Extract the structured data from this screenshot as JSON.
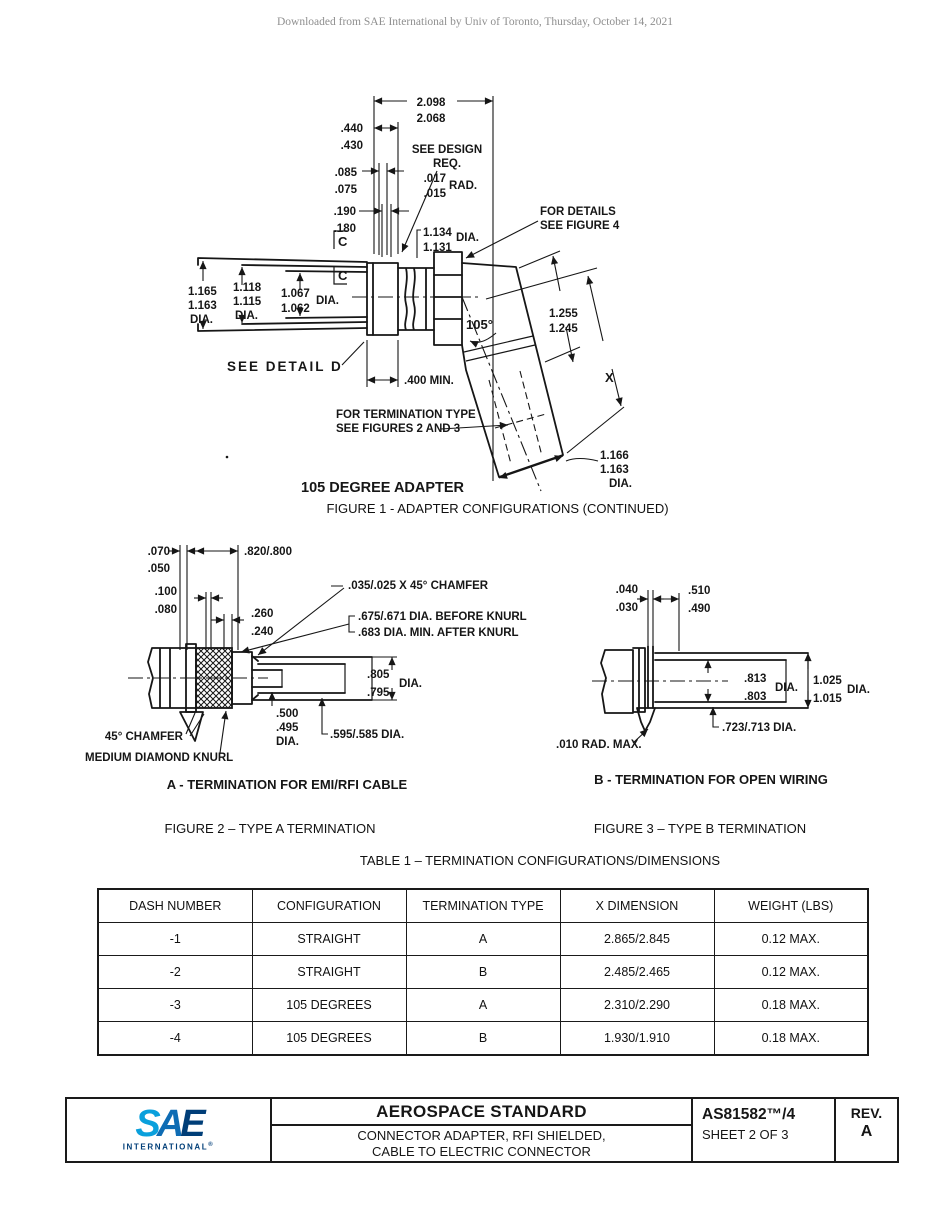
{
  "watermark": "Downloaded from SAE International by Univ of Toronto, Thursday, October 14, 2021",
  "figure1": {
    "title": "105 DEGREE ADAPTER",
    "caption": "FIGURE 1 - ADAPTER CONFIGURATIONS (CONTINUED)",
    "dims": {
      "overall": [
        "2.098",
        "2.068"
      ],
      "d440": [
        ".440",
        ".430"
      ],
      "design": [
        "SEE DESIGN",
        "REQ."
      ],
      "rad": [
        ".017",
        ".015",
        "RAD."
      ],
      "d085": [
        ".085",
        ".075"
      ],
      "d190": [
        ".190",
        ".180"
      ],
      "dia1134": [
        "1.134",
        "1.131",
        "DIA."
      ],
      "details": [
        "FOR DETAILS",
        "SEE FIGURE 4"
      ],
      "c": "C",
      "dia1165": [
        "1.165",
        "1.163",
        "DIA."
      ],
      "dia1118": [
        "1.118",
        "1.115",
        "DIA."
      ],
      "dia1067": [
        "1.067",
        "1.062",
        "DIA."
      ],
      "angle": "105°",
      "d1255": [
        "1.255",
        "1.245"
      ],
      "detail_d": "SEE DETAIL D",
      "min400": ".400 MIN.",
      "xdim": "X",
      "term": [
        "FOR TERMINATION TYPE",
        "SEE FIGURES 2 AND 3"
      ],
      "dia1166": [
        "1.166",
        "1.163",
        "DIA."
      ]
    }
  },
  "figure2": {
    "caption": "FIGURE 2 – TYPE A TERMINATION",
    "label": "A - TERMINATION FOR EMI/RFI CABLE",
    "dims": {
      "d070": [
        ".070",
        ".050"
      ],
      "d820": ".820/.800",
      "d100": [
        ".100",
        ".080"
      ],
      "d260": [
        ".260",
        ".240"
      ],
      "chamfer": ".035/.025 X 45° CHAMFER",
      "before_knurl": ".675/.671 DIA. BEFORE KNURL",
      "after_knurl": ".683 DIA. MIN. AFTER KNURL",
      "d805": [
        ".805",
        ".795",
        "DIA."
      ],
      "d500": [
        ".500",
        ".495",
        "DIA."
      ],
      "d595": ".595/.585 DIA.",
      "chamfer45": "45° CHAMFER",
      "knurl": "MEDIUM DIAMOND KNURL"
    }
  },
  "figure3": {
    "caption": "FIGURE 3 – TYPE B TERMINATION",
    "label": "B - TERMINATION FOR OPEN WIRING",
    "dims": {
      "d040": [
        ".040",
        ".030"
      ],
      "d510": [
        ".510",
        ".490"
      ],
      "d813": [
        ".813",
        ".803",
        "DIA."
      ],
      "d1025": [
        "1.025",
        "1.015",
        "DIA."
      ],
      "d723": ".723/.713 DIA.",
      "rad010": ".010 RAD. MAX."
    }
  },
  "table1": {
    "title": "TABLE 1 – TERMINATION CONFIGURATIONS/DIMENSIONS",
    "headers": [
      "DASH NUMBER",
      "CONFIGURATION",
      "TERMINATION TYPE",
      "X DIMENSION",
      "WEIGHT (LBS)"
    ],
    "rows": [
      [
        "-1",
        "STRAIGHT",
        "A",
        "2.865/2.845",
        "0.12 MAX."
      ],
      [
        "-2",
        "STRAIGHT",
        "B",
        "2.485/2.465",
        "0.12 MAX."
      ],
      [
        "-3",
        "105 DEGREES",
        "A",
        "2.310/2.290",
        "0.18 MAX."
      ],
      [
        "-4",
        "105 DEGREES",
        "B",
        "1.930/1.910",
        "0.18 MAX."
      ]
    ]
  },
  "titleblock": {
    "logo_s": "S",
    "logo_a": "A",
    "logo_e": "E",
    "logo_sub": "INTERNATIONAL",
    "logo_reg": "®",
    "doc_type": "AEROSPACE STANDARD",
    "subtitle1": "CONNECTOR ADAPTER, RFI SHIELDED,",
    "subtitle2": "CABLE TO ELECTRIC CONNECTOR",
    "doc_number": "AS81582™/4",
    "sheet": "SHEET 2 OF 3",
    "rev_label": "REV.",
    "rev_value": "A"
  }
}
